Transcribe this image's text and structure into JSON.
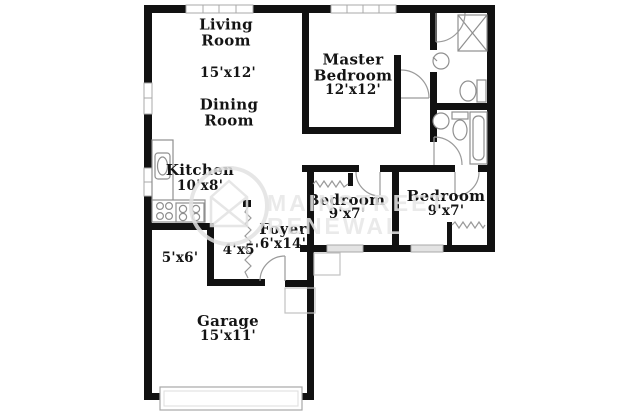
{
  "watermark": {
    "line1": "MAINSTREET",
    "line2": "RENEWAL",
    "logo": "house-in-circle-icon"
  },
  "labels": {
    "living_room": "Living Room",
    "living_dims": "15'x12'",
    "dining_room": "Dining Room",
    "master_bedroom": "Master Bedroom",
    "master_dims": "12'x12'",
    "kitchen": "Kitchen",
    "kitchen_dims": "10'x8'",
    "bedroom2": "Bedroom",
    "bedroom2_dims": "9'x7'",
    "bedroom3": "Bedroom",
    "bedroom3_dims": "9'x7'",
    "foyer": "Foyer",
    "foyer_dims": "6'x14'",
    "closet_dims": "4'x5'",
    "storage_dims": "5'x6'",
    "garage": "Garage",
    "garage_dims": "15'x11'"
  },
  "colors": {
    "wall": "#111111",
    "fixture_line": "#8f8f8f",
    "door_line": "#9a9a9a",
    "watermark": "#e7e7e7",
    "background": "#ffffff"
  }
}
